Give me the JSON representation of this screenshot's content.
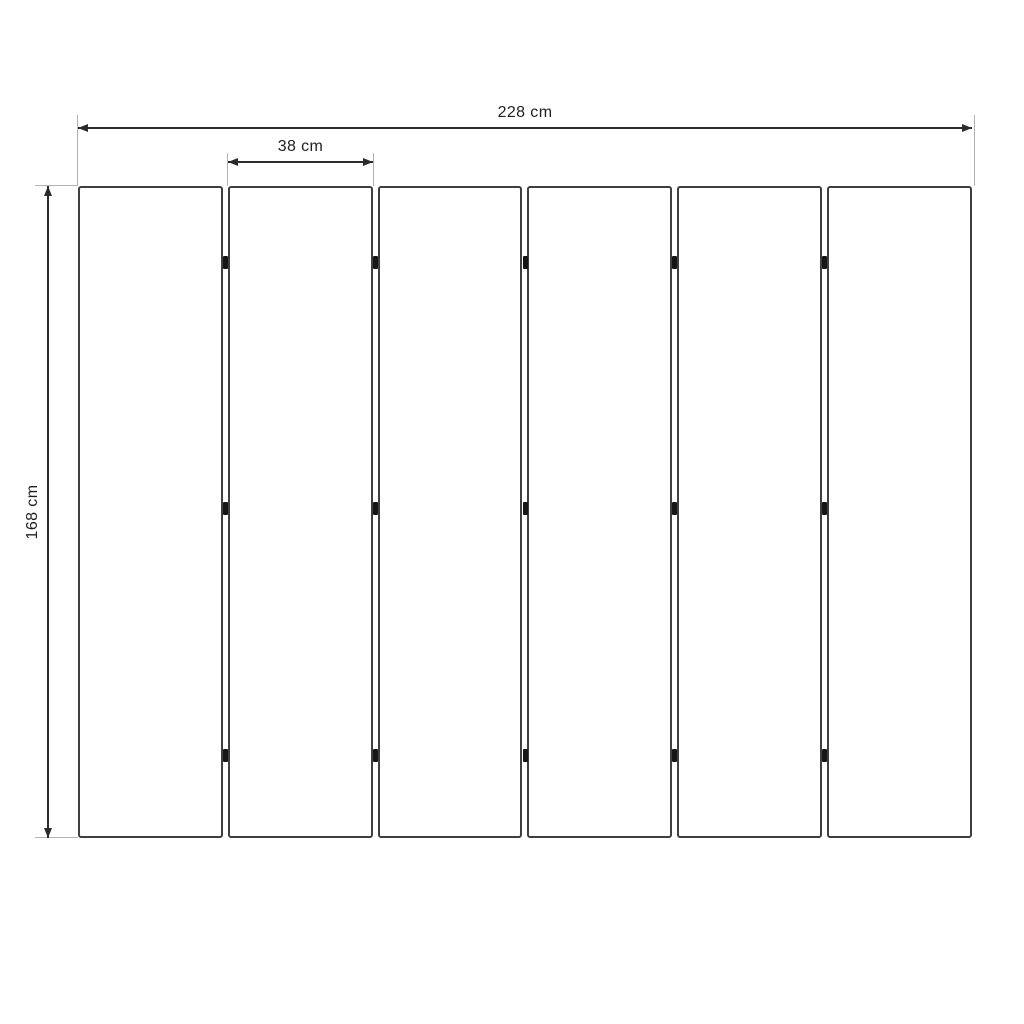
{
  "dimensions": {
    "total_width": {
      "label": "228 cm",
      "value_cm": 228
    },
    "panel_width": {
      "label": "38 cm",
      "value_cm": 38
    },
    "height": {
      "label": "168 cm",
      "value_cm": 168
    }
  },
  "panels": {
    "count": 6,
    "gap_count": 5,
    "hinges_per_gap": 3,
    "hinge_position_fractions": [
      0.118,
      0.494,
      0.873
    ]
  },
  "colors": {
    "background": "#ffffff",
    "panel_fill": "#ffffff",
    "panel_border": "#3f3f3f",
    "hinge": "#161616",
    "dimension_line": "#2b2b2b",
    "extension_line": "#b2b2b2",
    "text": "#1f1f1f"
  }
}
